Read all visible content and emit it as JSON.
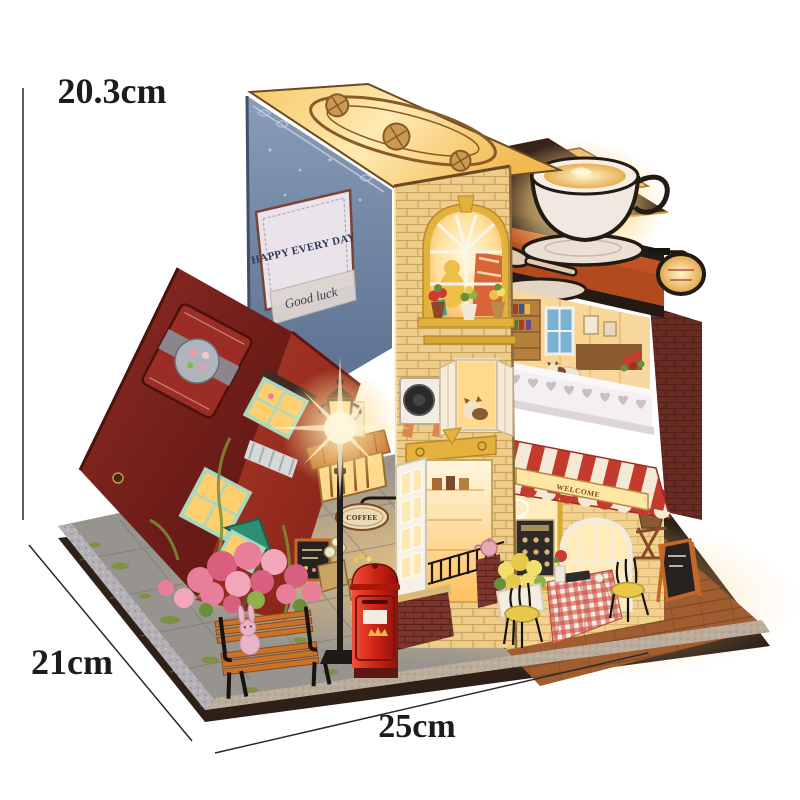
{
  "dimensions": {
    "height_label": "20.3cm",
    "depth_label": "21cm",
    "width_label": "25cm"
  },
  "signs": {
    "happy_sign": "HAPPY EVERY DAY",
    "good_luck": "Good luck",
    "time_shop": {
      "line1": "TIME",
      "line2": "BOOK",
      "line3": "SHOP"
    },
    "alley_sign": "COFFEE",
    "awning_sign": "WELCOME"
  },
  "icons": {
    "badge": "coffee-cup-icon",
    "big_sign": "coffee-cup-icon",
    "postbox": "crown-icon",
    "time_sign": "open-book-icon"
  },
  "colors": {
    "postbox_red": "#d93a28",
    "awning_red": "#c43a2c",
    "awning_cream": "#f3e9d6",
    "brick_cream": "#eccd8a",
    "book_blue": "#72879f",
    "book_red": "#7d241e",
    "glow_amber": "#ffd98a",
    "sign_navy": "#2e3a55",
    "mint_green": "#a8d8c0",
    "teal_sign": "#2e8f74",
    "bench_orange": "#c9722a",
    "balcony_white": "#f4eff2"
  }
}
